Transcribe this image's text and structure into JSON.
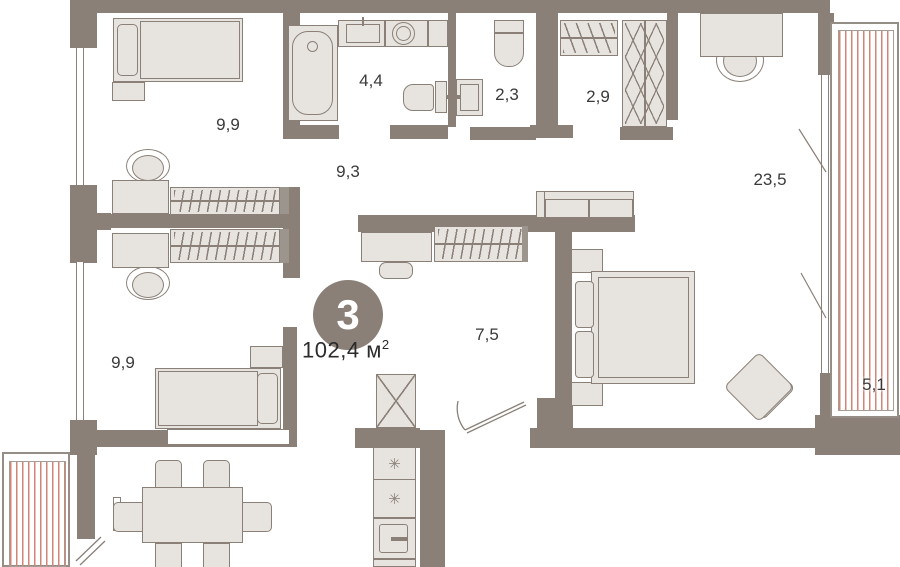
{
  "badge": {
    "rooms_count": "3",
    "area_value": "102,4",
    "area_unit": "м",
    "area_exponent": "2"
  },
  "room_labels": {
    "bedroom_top": "9,9",
    "bathroom": "4,4",
    "wc": "2,3",
    "closet": "2,9",
    "living": "23,5",
    "hallway": "9,3",
    "inner_hall": "7,5",
    "bedroom_bottom": "9,9",
    "balcony": "5,1"
  },
  "kitchen": {
    "burner_symbol": "✳"
  },
  "colors": {
    "wall": "#8a8078",
    "line": "#8a8078",
    "fill": "#e7e4df",
    "stripe": "#cf8577",
    "text": "#3a3a3a",
    "badge_text": "#ffffff"
  }
}
